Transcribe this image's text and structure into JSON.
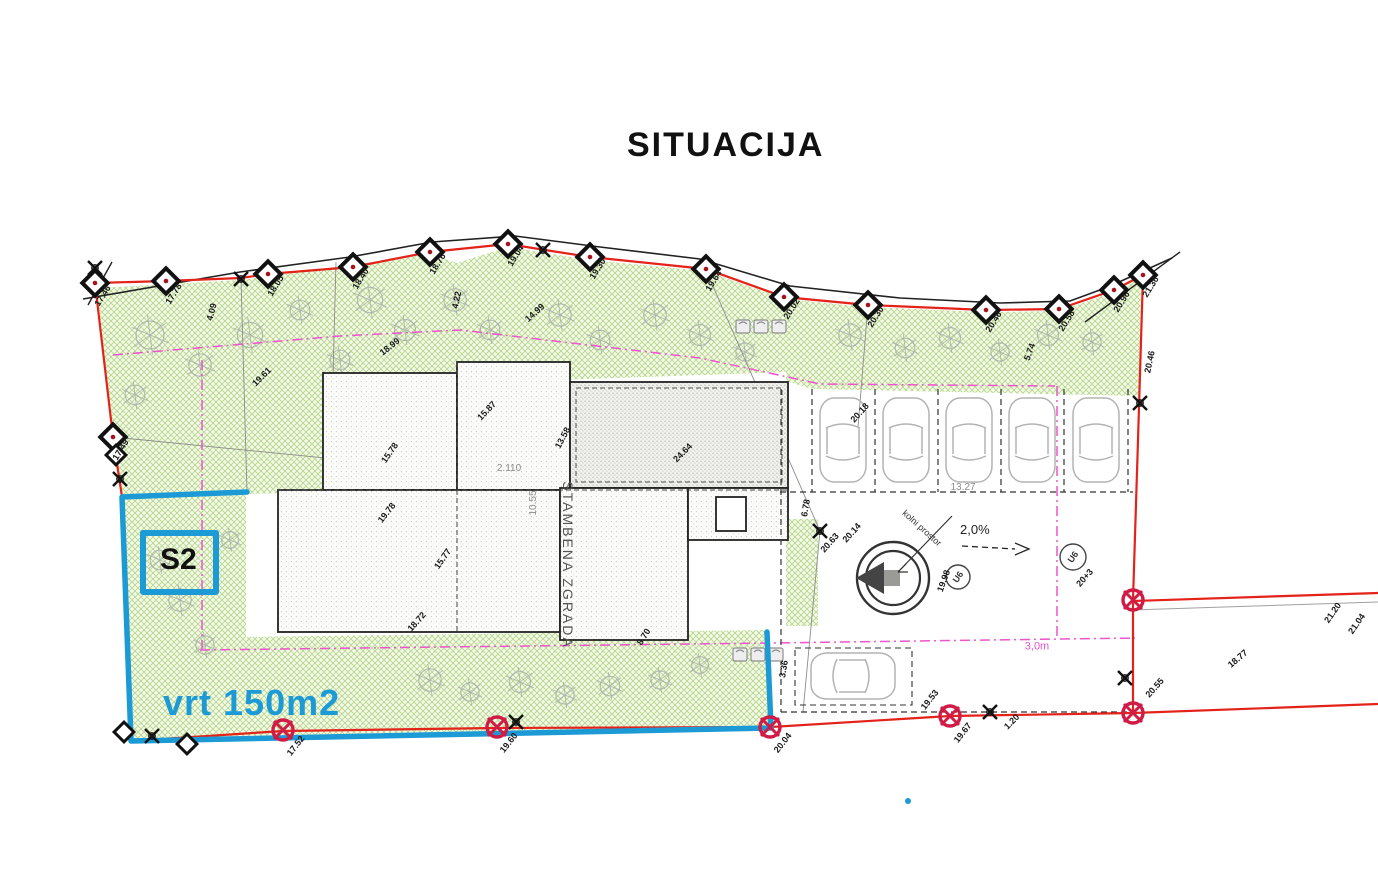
{
  "title": "SITUACIJA",
  "colors": {
    "boundary_red": "#e32219",
    "highlight_blue": "#1b9ad6",
    "magenta": "#ee54cc",
    "benchmark_red": "#cf1b45",
    "garden_green": "#86b83e",
    "tree_gray": "#9aa0a0"
  },
  "highlight": {
    "unit": "S2",
    "area": "vrt 150m2"
  },
  "building": {
    "label": "STAMBENA ZGRADA"
  },
  "labels": {
    "slope": "2,0%",
    "setback": "3,0m",
    "access": "kolni prostor",
    "utility1": "U6",
    "utility2": "U6",
    "parking_width": "13.27"
  },
  "dimensions": [
    [
      "17.46",
      103,
      296,
      -58
    ],
    [
      "17.78",
      174,
      294,
      -58
    ],
    [
      "18.05",
      276,
      286,
      -58
    ],
    [
      "18.40",
      361,
      279,
      -58
    ],
    [
      "18.76",
      438,
      264,
      -58
    ],
    [
      "19.04",
      516,
      256,
      -58
    ],
    [
      "19.30",
      598,
      269,
      -58
    ],
    [
      "19.64",
      714,
      281,
      -58
    ],
    [
      "20.02",
      792,
      309,
      -58
    ],
    [
      "20.30",
      876,
      317,
      -58
    ],
    [
      "20.46",
      994,
      322,
      -58
    ],
    [
      "20.58",
      1067,
      321,
      -58
    ],
    [
      "20.96",
      1122,
      302,
      -58
    ],
    [
      "21.36",
      1151,
      287,
      -58
    ],
    [
      "17.49",
      121,
      450,
      -58
    ],
    [
      "19.61",
      262,
      377,
      -45
    ],
    [
      "18.99",
      390,
      347,
      -38
    ],
    [
      "14.99",
      535,
      313,
      -42
    ],
    [
      "4.22",
      457,
      300,
      -78
    ],
    [
      "4.09",
      212,
      312,
      -75
    ],
    [
      "19.78",
      387,
      513,
      -52
    ],
    [
      "18.72",
      417,
      622,
      -48
    ],
    [
      "15.87",
      487,
      411,
      -46
    ],
    [
      "15.78",
      390,
      453,
      -55
    ],
    [
      "15.77",
      443,
      559,
      -55
    ],
    [
      "13.58",
      563,
      438,
      -62
    ],
    [
      "24.64",
      683,
      453,
      -45
    ],
    [
      "8.70",
      644,
      637,
      -58
    ],
    [
      "2.110",
      509,
      469,
      0,
      "g"
    ],
    [
      "10.55",
      534,
      503,
      -90,
      "g"
    ],
    [
      "13.27",
      963,
      488,
      0,
      "g"
    ],
    [
      "20.18",
      860,
      413,
      -48
    ],
    [
      "5.74",
      1030,
      352,
      -70
    ],
    [
      "20.46",
      1150,
      362,
      -78
    ],
    [
      "6.78",
      806,
      508,
      -80
    ],
    [
      "3.36",
      784,
      669,
      -80
    ],
    [
      "20.63",
      830,
      543,
      -48
    ],
    [
      "20.14",
      852,
      533,
      -48
    ],
    [
      "19.98",
      944,
      581,
      -70
    ],
    [
      "20+3",
      1085,
      578,
      -48
    ],
    [
      "19.53",
      930,
      700,
      -52
    ],
    [
      "19.67",
      963,
      733,
      -52
    ],
    [
      "1.20",
      1012,
      722,
      -45
    ],
    [
      "20.55",
      1155,
      688,
      -48
    ],
    [
      "21.20",
      1333,
      613,
      -55
    ],
    [
      "21.04",
      1357,
      624,
      -55
    ],
    [
      "18.77",
      1238,
      659,
      -40
    ],
    [
      "17.52",
      296,
      746,
      -52
    ],
    [
      "19.60",
      509,
      743,
      -52
    ],
    [
      "20.04",
      783,
      743,
      -52
    ],
    [
      "3,0m",
      1037,
      647,
      0,
      "m"
    ]
  ],
  "markers": {
    "diamonds": [
      [
        95,
        283
      ],
      [
        166,
        281
      ],
      [
        268,
        274
      ],
      [
        353,
        267
      ],
      [
        430,
        252
      ],
      [
        508,
        244
      ],
      [
        590,
        257
      ],
      [
        706,
        269
      ],
      [
        784,
        297
      ],
      [
        868,
        305
      ],
      [
        986,
        310
      ],
      [
        1059,
        309
      ],
      [
        1114,
        290
      ],
      [
        1143,
        275
      ],
      [
        113,
        437
      ]
    ],
    "diamonds_plain": [
      [
        116,
        455
      ],
      [
        124,
        732
      ],
      [
        187,
        744
      ]
    ],
    "crosses": [
      [
        241,
        279
      ],
      [
        543,
        250
      ],
      [
        95,
        268
      ],
      [
        120,
        479
      ],
      [
        820,
        531
      ],
      [
        1140,
        403
      ],
      [
        1125,
        678
      ],
      [
        516,
        722
      ],
      [
        152,
        736
      ],
      [
        990,
        712
      ]
    ],
    "benchmarks": [
      [
        283,
        730
      ],
      [
        497,
        727
      ],
      [
        770,
        727
      ],
      [
        950,
        716
      ],
      [
        1133,
        713
      ],
      [
        1133,
        600
      ]
    ]
  },
  "trees": [
    [
      150,
      335,
      20
    ],
    [
      200,
      365,
      16
    ],
    [
      135,
      395,
      14
    ],
    [
      250,
      335,
      18
    ],
    [
      300,
      310,
      14
    ],
    [
      370,
      300,
      18
    ],
    [
      405,
      330,
      15
    ],
    [
      340,
      360,
      14
    ],
    [
      455,
      300,
      16
    ],
    [
      490,
      330,
      14
    ],
    [
      560,
      315,
      16
    ],
    [
      600,
      340,
      14
    ],
    [
      655,
      315,
      16
    ],
    [
      700,
      335,
      15
    ],
    [
      745,
      352,
      13
    ],
    [
      850,
      335,
      16
    ],
    [
      905,
      348,
      14
    ],
    [
      950,
      338,
      15
    ],
    [
      1000,
      352,
      13
    ],
    [
      1048,
      335,
      15
    ],
    [
      1092,
      342,
      13
    ],
    [
      430,
      680,
      16
    ],
    [
      470,
      692,
      13
    ],
    [
      520,
      682,
      15
    ],
    [
      565,
      695,
      13
    ],
    [
      610,
      686,
      14
    ],
    [
      180,
      600,
      16
    ],
    [
      205,
      645,
      13
    ],
    [
      160,
      560,
      14
    ],
    [
      230,
      540,
      12
    ],
    [
      660,
      680,
      13
    ],
    [
      700,
      665,
      12
    ]
  ],
  "parking": {
    "stall_lines_x": [
      812,
      875,
      938,
      1001,
      1064,
      1128
    ],
    "car_centers_x": [
      843,
      906,
      969,
      1032,
      1096
    ],
    "car_row_y": 440,
    "parallel_car": [
      853,
      676
    ]
  },
  "bins": [
    [
      736,
      320
    ],
    [
      754,
      320
    ],
    [
      772,
      320
    ],
    [
      733,
      648
    ],
    [
      751,
      648
    ],
    [
      769,
      648
    ]
  ]
}
